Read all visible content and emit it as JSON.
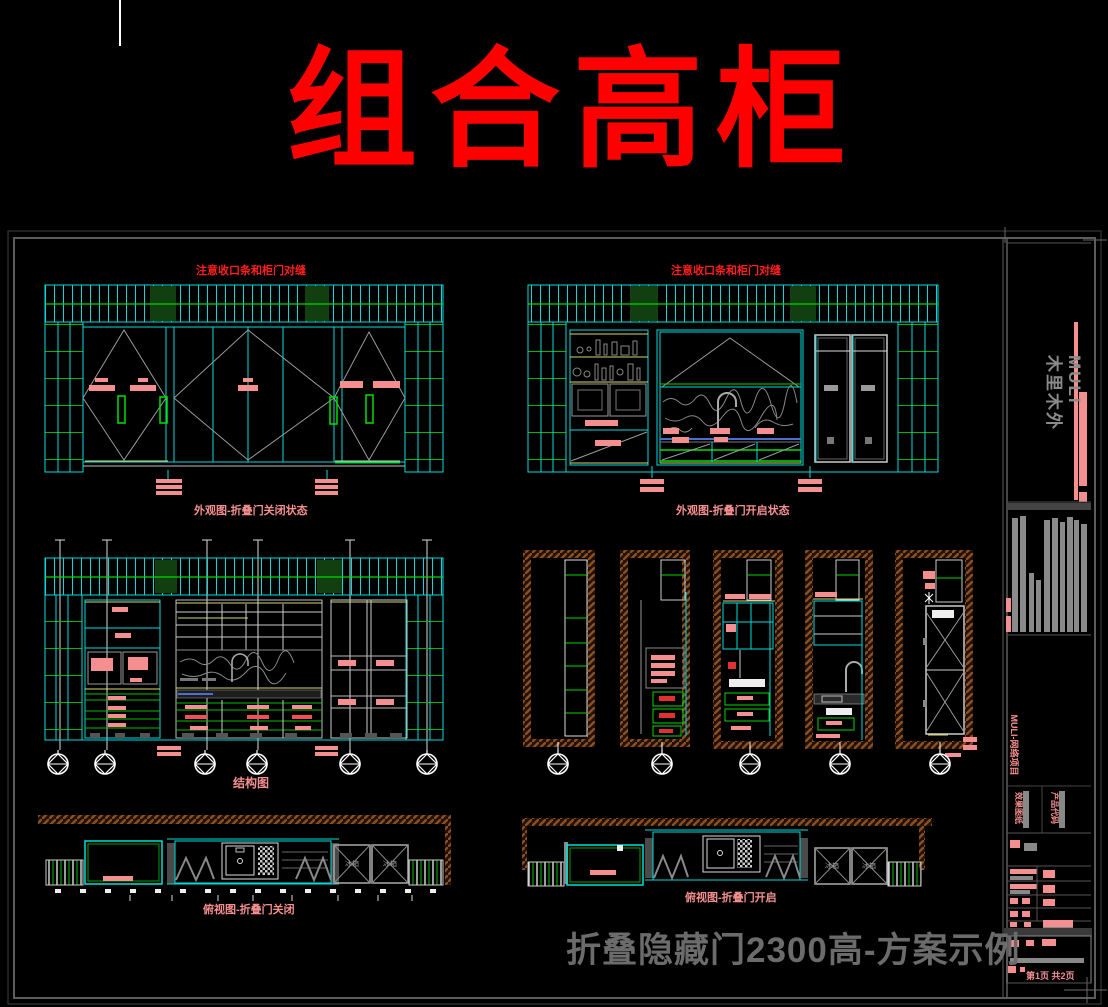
{
  "page_title": "组合高柜",
  "drawing_notes": {
    "seam_note_left": "注意收口条和柜门对缝",
    "seam_note_right": "注意收口条和柜门对缝"
  },
  "captions": {
    "elevation_closed": "外观图-折叠门关闭状态",
    "elevation_open": "外观图-折叠门开启状态",
    "structure": "结构图",
    "plan_closed": "俯视图-折叠门关闭",
    "plan_open": "俯视图-折叠门开启"
  },
  "plan_labels": {
    "appliance_box_1": "冰箱",
    "appliance_box_2": "冰箱"
  },
  "footer": {
    "scheme_title": "折叠隐藏门2300高-方案示例"
  },
  "title_block": {
    "brand_en": "MULI",
    "brand_cn": "木里木外",
    "project_label": "MULI-网络项目",
    "doc_label_1": "效果图纸",
    "doc_label_2": "产品代码",
    "page_info": "第1页 共2页"
  },
  "colors": {
    "background": "#000000",
    "title_red": "#ff0000",
    "note_red": "#ff1f1f",
    "label_pink": "#f58f8f",
    "cad_cyan": "#00dcdc",
    "cad_green": "#00d800",
    "cad_yellow": "#d8d870",
    "hatch_brown": "#8a4f22",
    "line_gray": "#9a9a9a",
    "footer_gray": "#6b6b6b"
  }
}
